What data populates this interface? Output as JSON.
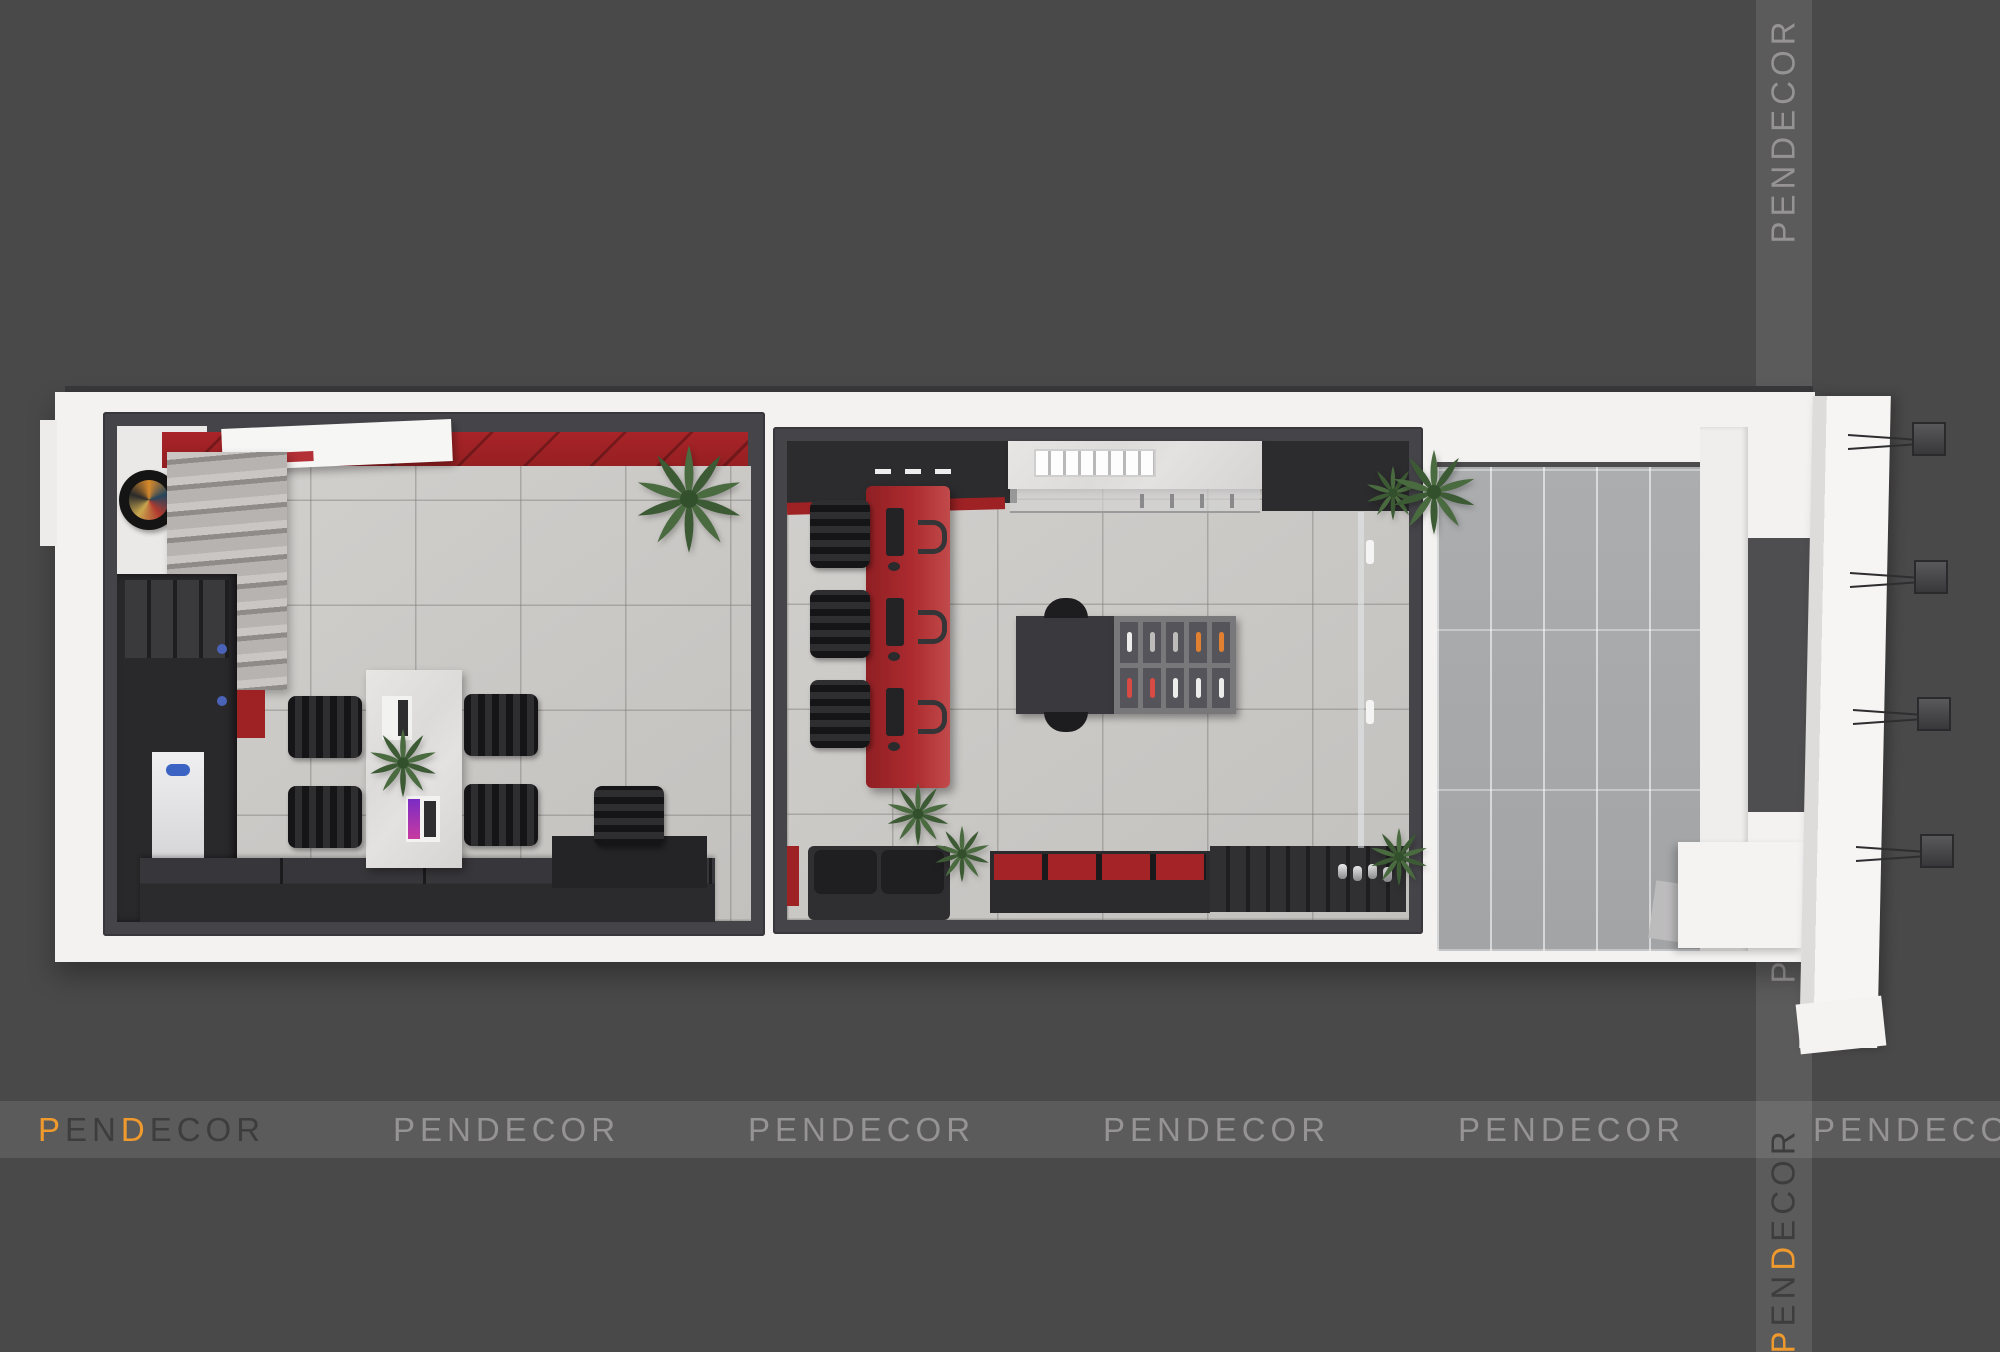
{
  "brand": {
    "name": "PENDECOR",
    "letters": {
      "p": "P",
      "en": "EN",
      "d": "D",
      "ecor": "ECOR"
    }
  },
  "watermarks": {
    "bottom_row_count": 6,
    "right_column_count": 4,
    "accent_positions": "first bottom-left logo and lowest right-strip logo use orange P and D"
  },
  "colors": {
    "background": "#4A4949",
    "watermark_accent_orange": "#F09A2E",
    "watermark_dark_letters": "#3E3D3D",
    "watermark_light_letters": "#CDCCCB",
    "building_white": "#F3F2F1",
    "wall_frame_dark": "#454449",
    "room_floor_tile": "#CBC9C6",
    "porch_plank_floor": "#A6A8AA",
    "accent_wall_red": "#9E2124",
    "reception_desk_red": "#AC2B2F",
    "furniture_black": "#2A292B",
    "marble_surface": "#E0DFDD",
    "plant_green": "#4A6B3F"
  }
}
